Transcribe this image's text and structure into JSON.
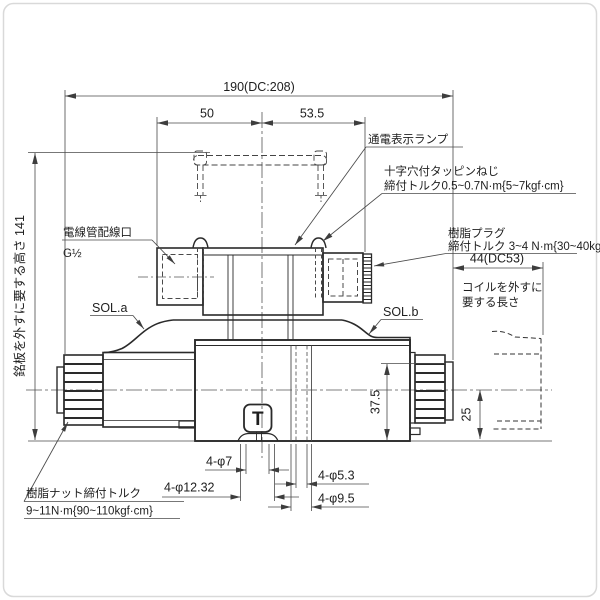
{
  "drawing": {
    "dimensions": {
      "total_width": "190(DC:208)",
      "left_to_center": "50",
      "center_to_plug": "53.5",
      "nameplate_height": "銘板を外すに要する高さ 141",
      "coil_removal_width": "44(DC53)",
      "body_height": "37.5",
      "coil_offset": "25",
      "port_hole_dia": "4-φ7",
      "port_spotface_dia": "4-φ12.32",
      "bolt_hole_dia": "4-φ5.3",
      "counterbore_dia": "4-φ9.5"
    },
    "labels": {
      "power_lamp": "通電表示ランプ",
      "tapping_screw_line1": "十字穴付タッピンねじ",
      "tapping_screw_line2": "締付トルク0.5~0.7N·m{5~7kgf·cm}",
      "resin_plug_line1": "樹脂プラグ",
      "resin_plug_line2": "締付トルク 3~4 N·m{30~40kgf·cm}",
      "conduit_port_line1": "電線管配線口",
      "conduit_port_line2": "G½",
      "sol_a": "SOL.a",
      "sol_b": "SOL.b",
      "coil_removal_line1": "コイルを外すに",
      "coil_removal_line2": "要する長さ",
      "resin_nut_line1": "樹脂ナット締付トルク",
      "resin_nut_line2": "9~11N·m{90~110kgf·cm}",
      "port_mark": "T"
    },
    "colors": {
      "line": "#2a2a2a",
      "dim_line": "#4a4a4a",
      "background": "#ffffff",
      "border": "#d9d9d9"
    }
  }
}
